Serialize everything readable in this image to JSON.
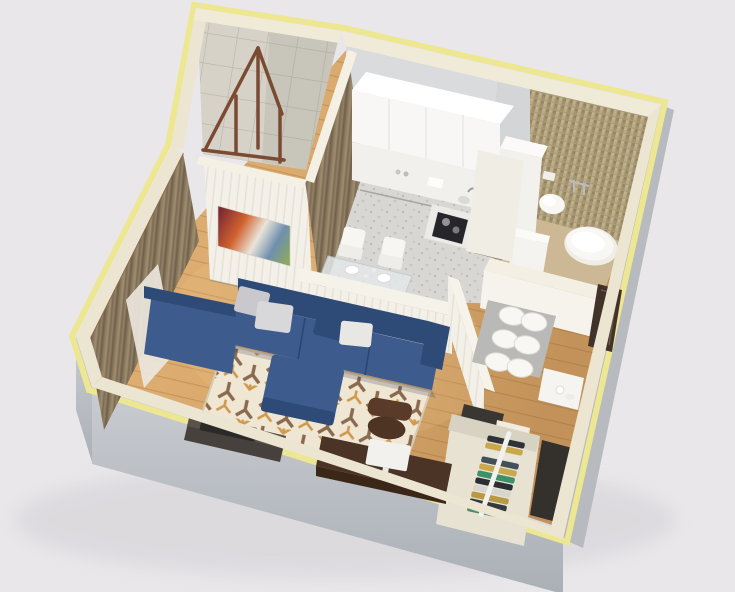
{
  "scene": {
    "description": "Photorealistic isometric 3D cutaway render of a small one-room apartment floor plan, no text or UI elements visible",
    "view": "top-down isometric, apartment rotated roughly 45 degrees",
    "canvas": {
      "width": 735,
      "height": 592
    }
  },
  "palette": {
    "bg": "#e9e7ea",
    "shadow": "#d9d6db",
    "wall_top_cream": "#ece5d2",
    "wall_top_light": "#f0ead9",
    "wall_edge_yellow": "#eee791",
    "wall_outer_gray": "#b7bbc0",
    "wall_inner_white": "#f3f0e8",
    "wood_floor": "#d6a76a",
    "wood_dark": "#b98a52",
    "kitchen_floor": "#d9d7d3",
    "bath_floor": "#cdb896",
    "mosaic_tile": "#ab9b79",
    "balcony_tile": "#d6d2c8",
    "sofa_navy": "#3d5c8d",
    "sofa_dark": "#2e4a77",
    "pillow_gray": "#c9c9cd",
    "pillow_white": "#e9e7e3",
    "rug_base": "#f0e6d4",
    "rug_brown": "#8a6a4e",
    "rug_orange": "#cf9a4e",
    "curtain_brown": "#8b7a60",
    "curtain_dark": "#6f5f48",
    "sheer_white": "#eae6dd",
    "cabinet_white": "#f8f7f5",
    "cooktop_black": "#26262a",
    "desk_brown": "#4b3425",
    "chair_brown": "#5a3b29",
    "tv_dark": "#47413d",
    "fixture_white": "#f8f7f4",
    "door_brown": "#42332a",
    "mat_gray": "#b9b9b7",
    "railing_brown": "#7b4a33",
    "glass_table": "#e3e8ea"
  },
  "rooms": {
    "living_room": {
      "floor": "light oak wood planks",
      "furniture": [
        "navy L-shaped sectional sofa with chaise",
        "navy square ottoman",
        "cream geometric patterned rug",
        "dark wood desk",
        "white monitor",
        "brown office chair",
        "dark TV console",
        "abstract wall art",
        "brown curtains with white sheer"
      ],
      "pillow_count": 4,
      "art_colors": [
        "#7e2b33",
        "#d1622f",
        "#e9e4da",
        "#6f8fae",
        "#8aa861"
      ]
    },
    "kitchen": {
      "floor": "light speckled stone",
      "furniture": [
        "white upper cabinet slab",
        "white base cabinets",
        "tall white cabinet",
        "black cooktop with pots",
        "sink with chrome faucet",
        "glass dining table",
        "white dining chairs",
        "white plates"
      ],
      "dining_chair_count": 2
    },
    "bathroom": {
      "floor": "beige tile",
      "walls": "beige mosaic tile",
      "furniture": [
        "wall-hung toilet",
        "freestanding oval bathtub",
        "small washbasin",
        "chrome wall faucets",
        "white washer cabinet"
      ]
    },
    "hallway": {
      "floor": "light oak wood planks",
      "furniture": [
        "gray floor mat",
        "white poufs",
        "white console with vase",
        "open closet with hanging clothes",
        "dark entry door"
      ],
      "pouf_count": 6,
      "closet_clothes_colors": [
        "#2f3338",
        "#c9a84b",
        "#e8e5dd",
        "#43505a",
        "#caa84e",
        "#3f8f6a",
        "#2b2e33",
        "#d8d5cd",
        "#b89a45",
        "#35383d",
        "#4a8f6e"
      ]
    },
    "balcony": {
      "walls": "square ceramic tile",
      "furniture": [
        "brown wooden railing frame"
      ]
    }
  }
}
